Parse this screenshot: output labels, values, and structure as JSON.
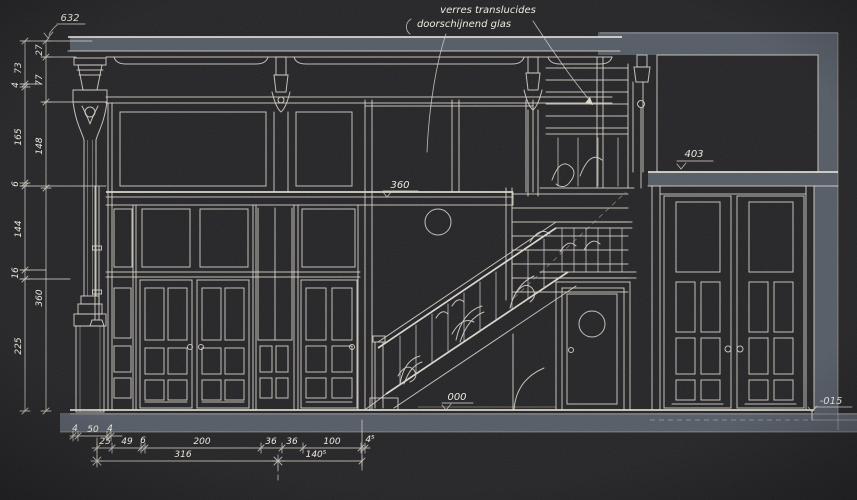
{
  "note": {
    "line1": "verres translucides",
    "line2": "doorschijnend glas"
  },
  "levels": {
    "cornice": "632",
    "landing": "360",
    "right_beam": "403",
    "ground": "000",
    "basement": "-015"
  },
  "dims": {
    "left_outer": [
      "73",
      "4",
      "165",
      "6",
      "144",
      "16",
      "225"
    ],
    "left_inner": [
      "27",
      "77",
      "148",
      "360"
    ],
    "base_row": [
      "4",
      "50",
      "4"
    ],
    "plan_row": [
      "25",
      "49",
      "6",
      "200",
      "36",
      "36",
      "100",
      "4⁵"
    ],
    "total_row": [
      "316",
      "140⁵"
    ]
  },
  "colors": {
    "background": "#232225",
    "line": "#d8d5c9",
    "wall_section": "#535a64",
    "text": "#edeadf"
  }
}
